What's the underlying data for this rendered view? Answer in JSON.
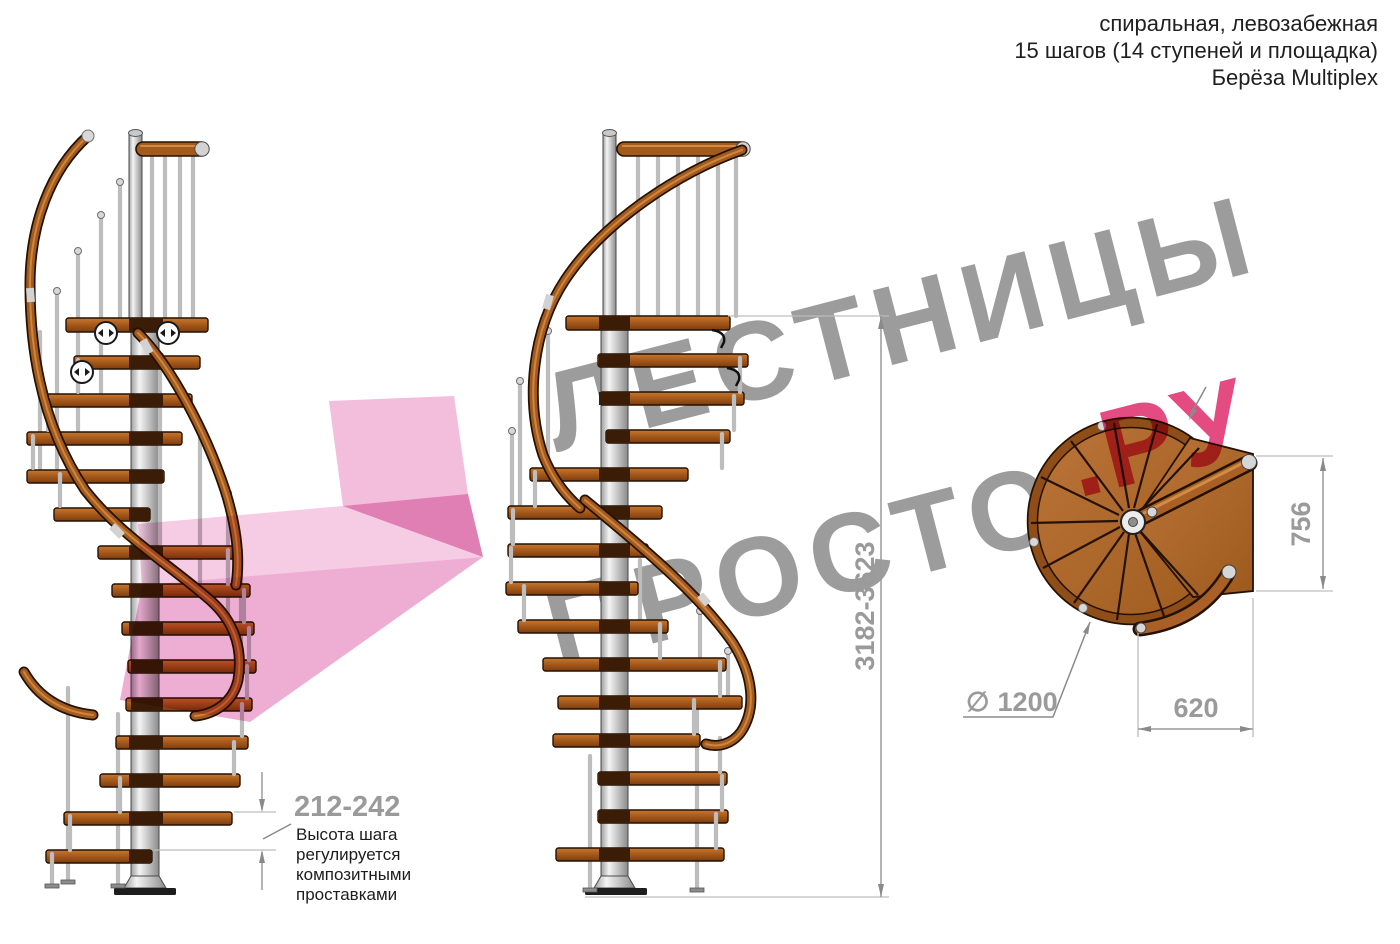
{
  "header": {
    "line1": "спиральная, левозабежная",
    "line2": "15 шагов (14 ступеней и площадка)",
    "line3": "Берёза Multiplex"
  },
  "watermark": {
    "brand_line1": "ЛЕСТНИЦЫ",
    "brand_line2_gray": "ПРОСТО",
    "brand_line2_pink": ".РУ"
  },
  "dimensions": {
    "total_height": "3182-3623",
    "step_height": "212-242",
    "landing_depth": "756",
    "landing_width": "620",
    "diameter_symbol": "∅",
    "diameter_value": "1200"
  },
  "annotation": {
    "line1": "Высота шага",
    "line2": "регулируется",
    "line3": "композитными",
    "line4": "проставками"
  },
  "colors": {
    "watermark_gray": "#9c9c9c",
    "watermark_pink": "#e44b80",
    "wood": "#a35b1d",
    "metal": "#c9c9c9",
    "dimension_gray": "#9a9a9a"
  }
}
